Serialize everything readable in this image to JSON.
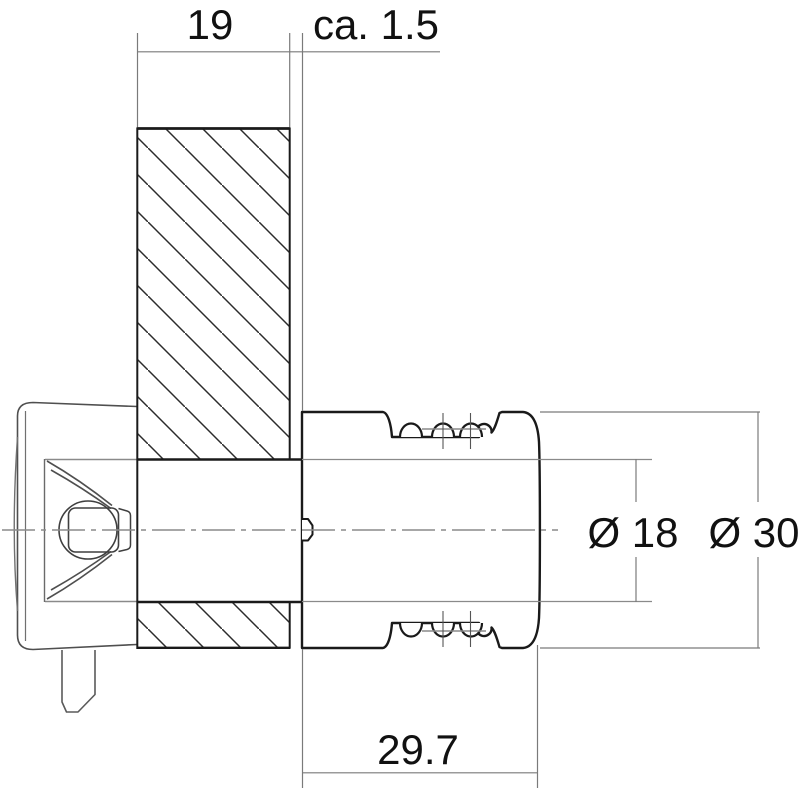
{
  "drawing": {
    "title": "Cam lock installation cross-section",
    "dims": {
      "panel_thickness": "19",
      "front_protrusion": "ca. 1.5",
      "housing_length": "29.7",
      "diameter_inner": "Ø 18",
      "diameter_outer": "Ø 30"
    },
    "colors": {
      "outline": "#1a1a1a",
      "thin_line": "#7a7a7a",
      "detail_line": "#4f4f4f",
      "hatch_line": "#2b2b2b",
      "background": "#ffffff"
    }
  }
}
